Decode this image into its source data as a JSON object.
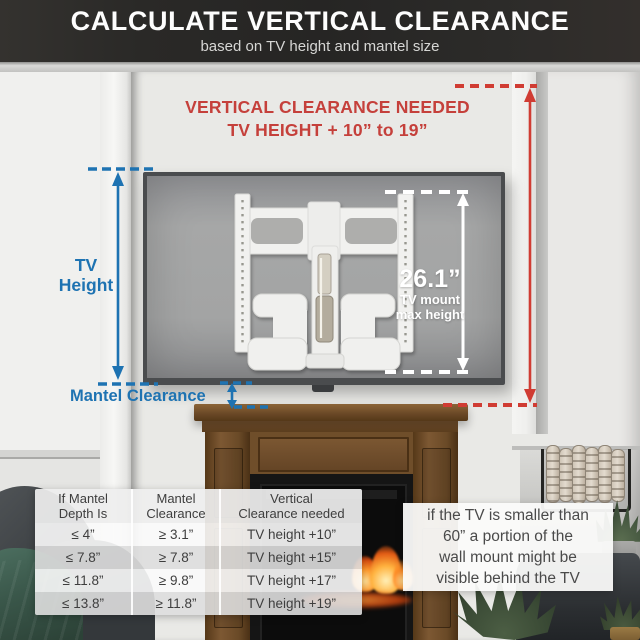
{
  "header": {
    "title": "CALCULATE VERTICAL CLEARANCE",
    "subtitle": "based on TV height and mantel size"
  },
  "annotations": {
    "vertical_clearance": {
      "line1": "VERTICAL CLEARANCE NEEDED",
      "line2": "TV HEIGHT + 10” to 19”"
    },
    "tv_height": {
      "line1": "TV",
      "line2": "Height"
    },
    "mantel_clearance": "Mantel Clearance",
    "tv_mount": {
      "value": "26.1”",
      "line1": "TV mount",
      "line2": "max height"
    }
  },
  "table": {
    "headers": [
      {
        "line1": "If Mantel",
        "line2": "Depth Is"
      },
      {
        "line1": "Mantel",
        "line2": "Clearance"
      },
      {
        "line1": "Vertical",
        "line2": "Clearance needed"
      }
    ],
    "rows": [
      [
        "≤ 4”",
        "≥ 3.1”",
        "TV height +10”"
      ],
      [
        "≤ 7.8”",
        "≥ 7.8”",
        "TV height +15”"
      ],
      [
        "≤ 11.8”",
        "≥ 9.8”",
        "TV height +17”"
      ],
      [
        "≤ 13.8”",
        "≥ 11.8”",
        "TV height +19”"
      ]
    ]
  },
  "note": {
    "lines": [
      "if the TV is smaller than",
      "60” a portion of the",
      "wall mount might be",
      "visible behind the TV"
    ]
  },
  "colors": {
    "accent_red": "#c5403b",
    "accent_blue": "#1e73b2"
  }
}
